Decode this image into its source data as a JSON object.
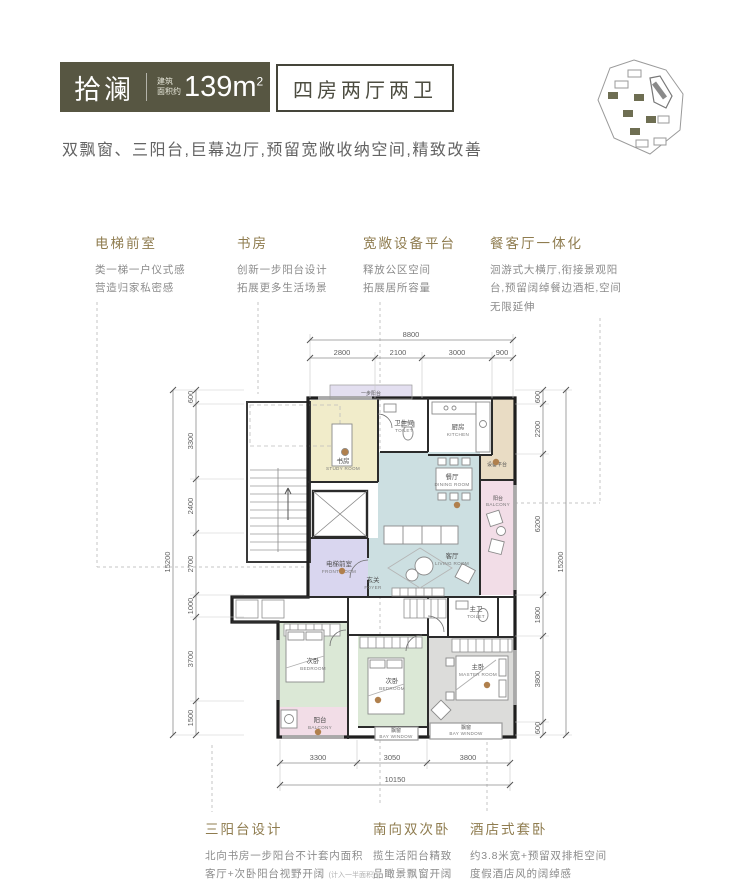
{
  "header": {
    "logo": "拾澜",
    "area_label_1": "建筑",
    "area_label_2": "面积约",
    "area_value": "139m",
    "area_sup": "2",
    "unit_type": "四房两厅两卫"
  },
  "tagline": "双飘窗、三阳台,巨幕边厅,预留宽敞收纳空间,精致改善",
  "features_top": [
    {
      "title": "电梯前室",
      "lines": [
        "类一梯一户仪式感",
        "营造归家私密感"
      ]
    },
    {
      "title": "书房",
      "lines": [
        "创新一步阳台设计",
        "拓展更多生活场景"
      ]
    },
    {
      "title": "宽敞设备平台",
      "lines": [
        "释放公区空间",
        "拓展居所容量"
      ]
    },
    {
      "title": "餐客厅一体化",
      "lines": [
        "洄游式大横厅,衔接景观阳",
        "台,预留阔绰餐边酒柜,空间",
        "无限延伸"
      ]
    }
  ],
  "features_bottom": [
    {
      "title": "三阳台设计",
      "lines": [
        "北向书房一步阳台不计套内面积",
        "客厅+次卧阳台视野开阔"
      ],
      "note": "(计入一半面积)"
    },
    {
      "title": "南向双次卧",
      "lines": [
        "揽生活阳台精致",
        "品瞰景飘窗开阔"
      ],
      "note": ""
    },
    {
      "title": "酒店式套卧",
      "lines": [
        "约3.8米宽+预留双排柜空间",
        "度假酒店风的阔绰感"
      ],
      "note": ""
    }
  ],
  "plan": {
    "top_label": "一步阳台",
    "rooms": {
      "study": {
        "zh": "书房",
        "en": "STUDY ROOM"
      },
      "toilet": {
        "zh": "卫生间",
        "en": "TOILET"
      },
      "kitchen": {
        "zh": "厨房",
        "en": "KITCHEN"
      },
      "equipment": {
        "zh": "设备平台",
        "en": ""
      },
      "dining": {
        "zh": "餐厅",
        "en": "DINING ROOM"
      },
      "living": {
        "zh": "客厅",
        "en": "LIVING ROOM"
      },
      "balcony_right": {
        "zh": "阳台",
        "en": "BALCONY"
      },
      "front_room": {
        "zh": "电梯前室",
        "en": "FRONT ROOM"
      },
      "foyer": {
        "zh": "玄关",
        "en": "FOYER"
      },
      "bedroom1": {
        "zh": "次卧",
        "en": "BEDROOM"
      },
      "bedroom2": {
        "zh": "次卧",
        "en": "BEDROOM"
      },
      "master": {
        "zh": "主卧",
        "en": "MASTER ROOM"
      },
      "master_toilet": {
        "zh": "主卫",
        "en": "TOILET"
      },
      "balcony_bottom": {
        "zh": "阳台",
        "en": "BALCONY"
      },
      "bay1": {
        "zh": "飘窗",
        "en": "BAY WINDOW"
      },
      "bay2": {
        "zh": "飘窗",
        "en": "BAY WINDOW"
      }
    },
    "dims": {
      "top_total": "8800",
      "top": [
        "2800",
        "2100",
        "3000",
        "900"
      ],
      "left_total": "15200",
      "left": [
        "600",
        "3300",
        "2400",
        "2700",
        "1000",
        "3700",
        "1500"
      ],
      "right_total": "15200",
      "right": [
        "600",
        "2200",
        "6200",
        "1800",
        "3800",
        "600"
      ],
      "bottom": [
        "3300",
        "3050",
        "3800"
      ],
      "bottom_total": "10150"
    }
  },
  "colors": {
    "header_bg": "#575642",
    "accent": "#8f7c4f",
    "marker": "#b0804d",
    "room_study": "#f1ecca",
    "room_living": "#ccdfe1",
    "room_bedroom": "#dbe8d6",
    "room_front": "#d9d6ef",
    "room_balcony": "#f2dde7",
    "room_master": "#dcdcda",
    "room_equipment": "#e9dcc4"
  }
}
